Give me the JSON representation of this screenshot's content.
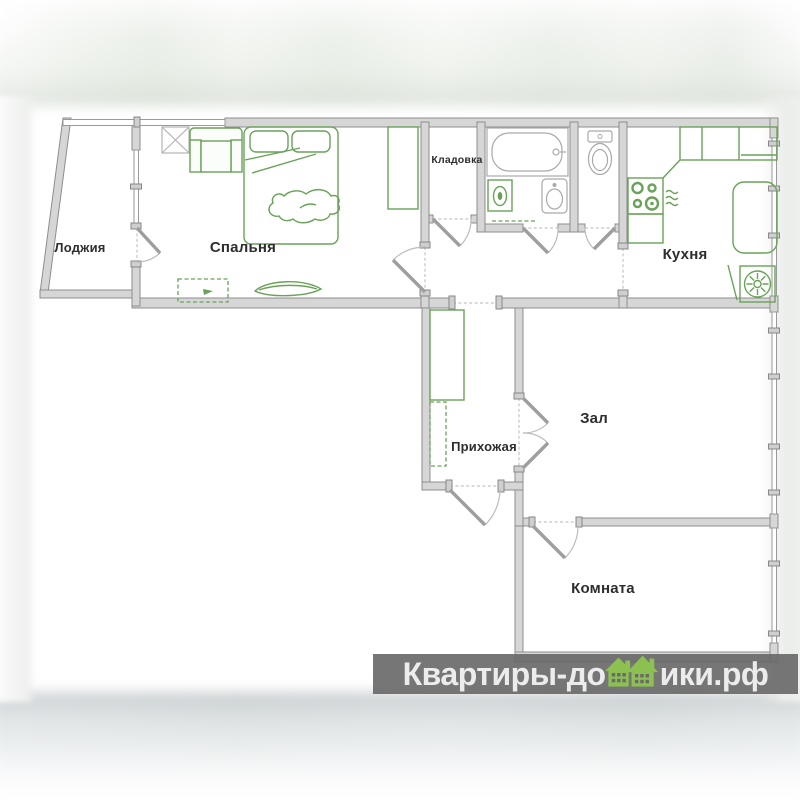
{
  "plan": {
    "rooms": [
      {
        "id": "loggia",
        "label": "Лоджия"
      },
      {
        "id": "bedroom",
        "label": "Спальня"
      },
      {
        "id": "storage",
        "label": "Кладовка"
      },
      {
        "id": "kitchen",
        "label": "Кухня"
      },
      {
        "id": "hallway",
        "label": "Прихожая"
      },
      {
        "id": "living",
        "label": "Зал"
      },
      {
        "id": "room",
        "label": "Комната"
      }
    ],
    "colors": {
      "wall_fill": "#d6d6d6",
      "wall_edge": "#8d8d8d",
      "furniture_green": "#69a258",
      "label_color": "#2e2e2e"
    }
  },
  "watermark": {
    "full_text": "Квартиры-домики.рф",
    "text_before": "Квартиры-до",
    "text_after": "ики.рф",
    "bar_color": "#676767",
    "text_color": "#ececec",
    "logo_green": "#8cc152"
  }
}
